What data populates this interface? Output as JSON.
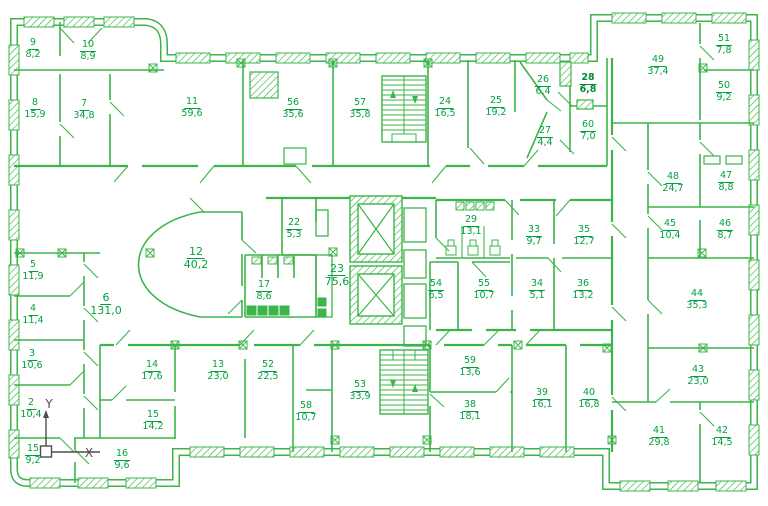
{
  "drawing": {
    "type": "architectural floor plan",
    "style": "CAD line drawing, green on white"
  },
  "colors": {
    "wall": "#3cb44a",
    "text": "#00a23f",
    "selected_text": "#008a36",
    "ucs_icon": "#4d4d4d",
    "background": "#ffffff"
  },
  "ucs": {
    "x_label": "X",
    "y_label": "Y"
  },
  "selected_room_number": "28",
  "rooms": [
    {
      "number": "9",
      "area": "8,2"
    },
    {
      "number": "10",
      "area": "8,9"
    },
    {
      "number": "8",
      "area": "15,9"
    },
    {
      "number": "7",
      "area": "34,8"
    },
    {
      "number": "11",
      "area": "59,6"
    },
    {
      "number": "56",
      "area": "35,6"
    },
    {
      "number": "57",
      "area": "35,8"
    },
    {
      "number": "24",
      "area": "16,5"
    },
    {
      "number": "25",
      "area": "19,2"
    },
    {
      "number": "26",
      "area": "6,4"
    },
    {
      "number": "27",
      "area": "4,4"
    },
    {
      "number": "28",
      "area": "6,8",
      "emphasis": "selected"
    },
    {
      "number": "60",
      "area": "7,0"
    },
    {
      "number": "49",
      "area": "37,4"
    },
    {
      "number": "51",
      "area": "7,8"
    },
    {
      "number": "50",
      "area": "9,2"
    },
    {
      "number": "48",
      "area": "24,7"
    },
    {
      "number": "47",
      "area": "8,8"
    },
    {
      "number": "45",
      "area": "10,4"
    },
    {
      "number": "46",
      "area": "8,7"
    },
    {
      "number": "44",
      "area": "35,3"
    },
    {
      "number": "43",
      "area": "23,0"
    },
    {
      "number": "41",
      "area": "29,8"
    },
    {
      "number": "42",
      "area": "14,5"
    },
    {
      "number": "5",
      "area": "11,9"
    },
    {
      "number": "4",
      "area": "11,4"
    },
    {
      "number": "3",
      "area": "10,6"
    },
    {
      "number": "2",
      "area": "10,4"
    },
    {
      "number": "15",
      "area": "9,2"
    },
    {
      "number": "16",
      "area": "9,6"
    },
    {
      "number": "6",
      "area": "131,0"
    },
    {
      "number": "12",
      "area": "40,2"
    },
    {
      "number": "22",
      "area": "5,3"
    },
    {
      "number": "17",
      "area": "8,6"
    },
    {
      "number": "23",
      "area": "75,6"
    },
    {
      "number": "54",
      "area": "6,5"
    },
    {
      "number": "29",
      "area": "13,1"
    },
    {
      "number": "55",
      "area": "10,7"
    },
    {
      "number": "33",
      "area": "9,7"
    },
    {
      "number": "35",
      "area": "12,7"
    },
    {
      "number": "34",
      "area": "5,1"
    },
    {
      "number": "36",
      "area": "13,2"
    },
    {
      "number": "14",
      "area": "17,6"
    },
    {
      "number": "13",
      "area": "23,0"
    },
    {
      "number": "52",
      "area": "22,5"
    },
    {
      "number": "15",
      "area": "14,2"
    },
    {
      "number": "58",
      "area": "10,7"
    },
    {
      "number": "53",
      "area": "33,9"
    },
    {
      "number": "59",
      "area": "13,6"
    },
    {
      "number": "38",
      "area": "18,1"
    },
    {
      "number": "39",
      "area": "16,1"
    },
    {
      "number": "40",
      "area": "16,8"
    }
  ]
}
